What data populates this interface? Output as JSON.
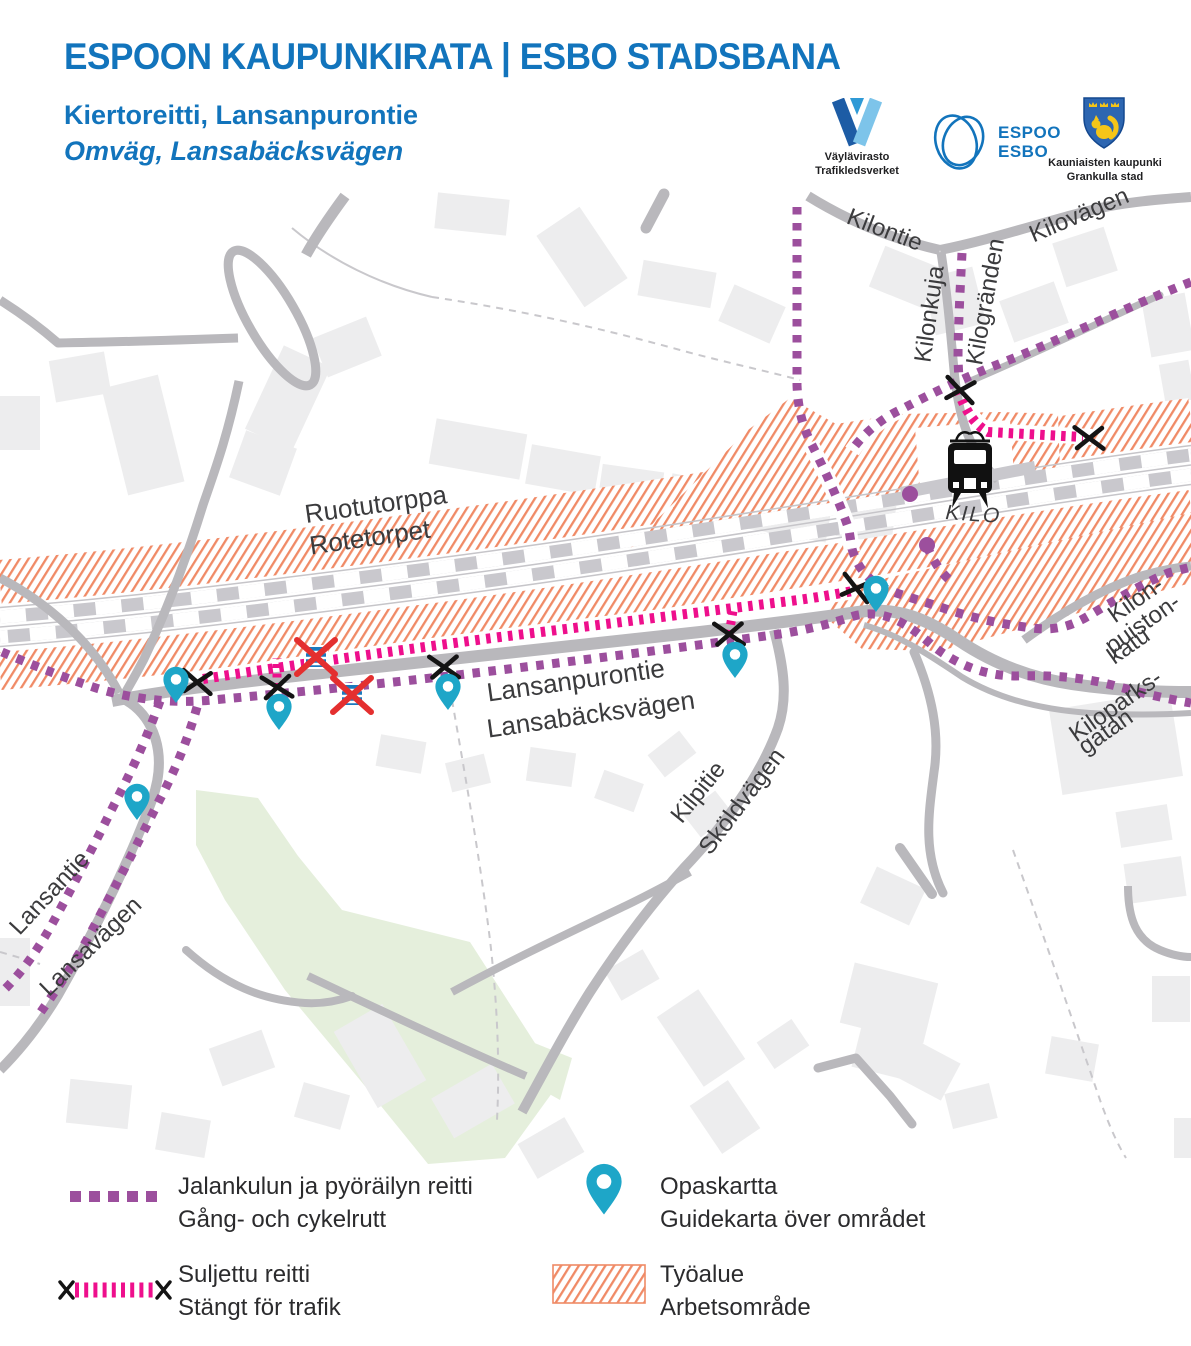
{
  "header": {
    "title": "ESPOON KAUPUNKIRATA | ESBO STADSBANA",
    "subtitle_fi": "Kiertoreitti, Lansanpurontie",
    "subtitle_sv": "Omväg, Lansabäcksvägen"
  },
  "logos": {
    "vaylavirasto": {
      "line1": "Väylävirasto",
      "line2": "Trafikledsverket"
    },
    "espoo": {
      "line1": "ESPOO",
      "line2": "ESBO"
    },
    "kauniainen": {
      "line1": "Kauniaisten kaupunki",
      "line2": "Grankulla stad"
    }
  },
  "map": {
    "station": {
      "name": "KILO"
    },
    "labels": [
      {
        "id": "kilontie",
        "text": "Kilontie",
        "x": 882,
        "y": 237,
        "rotate": 21,
        "size": 24
      },
      {
        "id": "kilovagen",
        "text": "Kilovägen",
        "x": 1082,
        "y": 222,
        "rotate": -23,
        "size": 24
      },
      {
        "id": "kilonkuja",
        "text": "Kilonkuja",
        "x": 937,
        "y": 315,
        "rotate": -82,
        "size": 24
      },
      {
        "id": "kilogranden",
        "text": "Kilogränden",
        "x": 993,
        "y": 303,
        "rotate": -80,
        "size": 24
      },
      {
        "id": "ruotutorppa",
        "text": "Ruotutorppa",
        "x": 377,
        "y": 513,
        "rotate": -8,
        "size": 26
      },
      {
        "id": "rotetorpet",
        "text": "Rotetorpet",
        "x": 371,
        "y": 546,
        "rotate": -8,
        "size": 26
      },
      {
        "id": "kilo-station",
        "text": "KILO",
        "x": 973,
        "y": 521,
        "rotate": 4,
        "size": 21,
        "italic": true,
        "spacing": 2
      },
      {
        "id": "lansanpurontie",
        "text": "Lansanpurontie",
        "x": 577,
        "y": 689,
        "rotate": -8,
        "size": 26
      },
      {
        "id": "lansabacksvagen",
        "text": "Lansabäcksvägen",
        "x": 592,
        "y": 723,
        "rotate": -8,
        "size": 26
      },
      {
        "id": "kilpitie",
        "text": "Kilpitie",
        "x": 704,
        "y": 797,
        "rotate": -51,
        "size": 24
      },
      {
        "id": "skoldvagen",
        "text": "Sköldvägen",
        "x": 748,
        "y": 806,
        "rotate": -53,
        "size": 24
      },
      {
        "id": "lansantie",
        "text": "Lansantie",
        "x": 55,
        "y": 898,
        "rotate": -47,
        "size": 24
      },
      {
        "id": "lansavagen",
        "text": "Lansavägen",
        "x": 96,
        "y": 952,
        "rotate": -44,
        "size": 24
      },
      {
        "id": "kilonpuistonkatu-1",
        "text": "Kilon-",
        "x": 1140,
        "y": 606,
        "rotate": -35,
        "size": 24
      },
      {
        "id": "kilonpuistonkatu-2",
        "text": "puiston-",
        "x": 1147,
        "y": 630,
        "rotate": -35,
        "size": 24
      },
      {
        "id": "kilonpuistonkatu-3",
        "text": "katu",
        "x": 1133,
        "y": 652,
        "rotate": -35,
        "size": 24
      },
      {
        "id": "kiloparksgatan-1",
        "text": "Kiloparks-",
        "x": 1120,
        "y": 712,
        "rotate": -35,
        "size": 24
      },
      {
        "id": "kiloparksgatan-2",
        "text": "gatan",
        "x": 1110,
        "y": 738,
        "rotate": -35,
        "size": 24
      }
    ],
    "pins": [
      {
        "x": 176,
        "y": 703
      },
      {
        "x": 279,
        "y": 730
      },
      {
        "x": 448,
        "y": 710
      },
      {
        "x": 735,
        "y": 678
      },
      {
        "x": 876,
        "y": 612
      },
      {
        "x": 137,
        "y": 820
      }
    ],
    "closed_marks": [
      {
        "x": 197,
        "y": 682,
        "rotate": 15
      },
      {
        "x": 277,
        "y": 687,
        "rotate": 5
      },
      {
        "x": 444,
        "y": 667,
        "rotate": 8
      },
      {
        "x": 729,
        "y": 634,
        "rotate": 8
      },
      {
        "x": 856,
        "y": 588,
        "rotate": 25
      },
      {
        "x": 960,
        "y": 390,
        "rotate": 20
      },
      {
        "x": 1089,
        "y": 438,
        "rotate": 10
      }
    ],
    "closed_crossing_icons": [
      {
        "x": 316,
        "y": 657
      },
      {
        "x": 352,
        "y": 695
      }
    ],
    "route_endpoints": [
      {
        "x": 910,
        "y": 494
      },
      {
        "x": 927,
        "y": 545
      }
    ]
  },
  "legend": {
    "items": [
      {
        "id": "detour-route",
        "label_fi": "Jalankulun ja pyöräilyn reitti",
        "label_sv": "Gång- och cykelrutt"
      },
      {
        "id": "closed-route",
        "label_fi": "Suljettu reitti",
        "label_sv": "Stängt för trafik"
      },
      {
        "id": "guide-map",
        "label_fi": "Opaskartta",
        "label_sv": "Guidekarta över området"
      },
      {
        "id": "work-area",
        "label_fi": "Työalue",
        "label_sv": "Arbetsområde"
      }
    ]
  },
  "colors": {
    "title_blue": "#1274bc",
    "route_detour_purple": "#9c4f9d",
    "route_closed_pink": "#ee0f8c",
    "guide_pin_teal": "#1ea6c8",
    "work_area_orange": "#f08a66",
    "road_gray": "#b9b8bc",
    "building_gray": "#ededee",
    "park_green": "#e5efdc",
    "railway_gray": "#c9c8cd",
    "map_label_dark": "#3b3b3d",
    "legend_text": "#2b2b2d"
  }
}
